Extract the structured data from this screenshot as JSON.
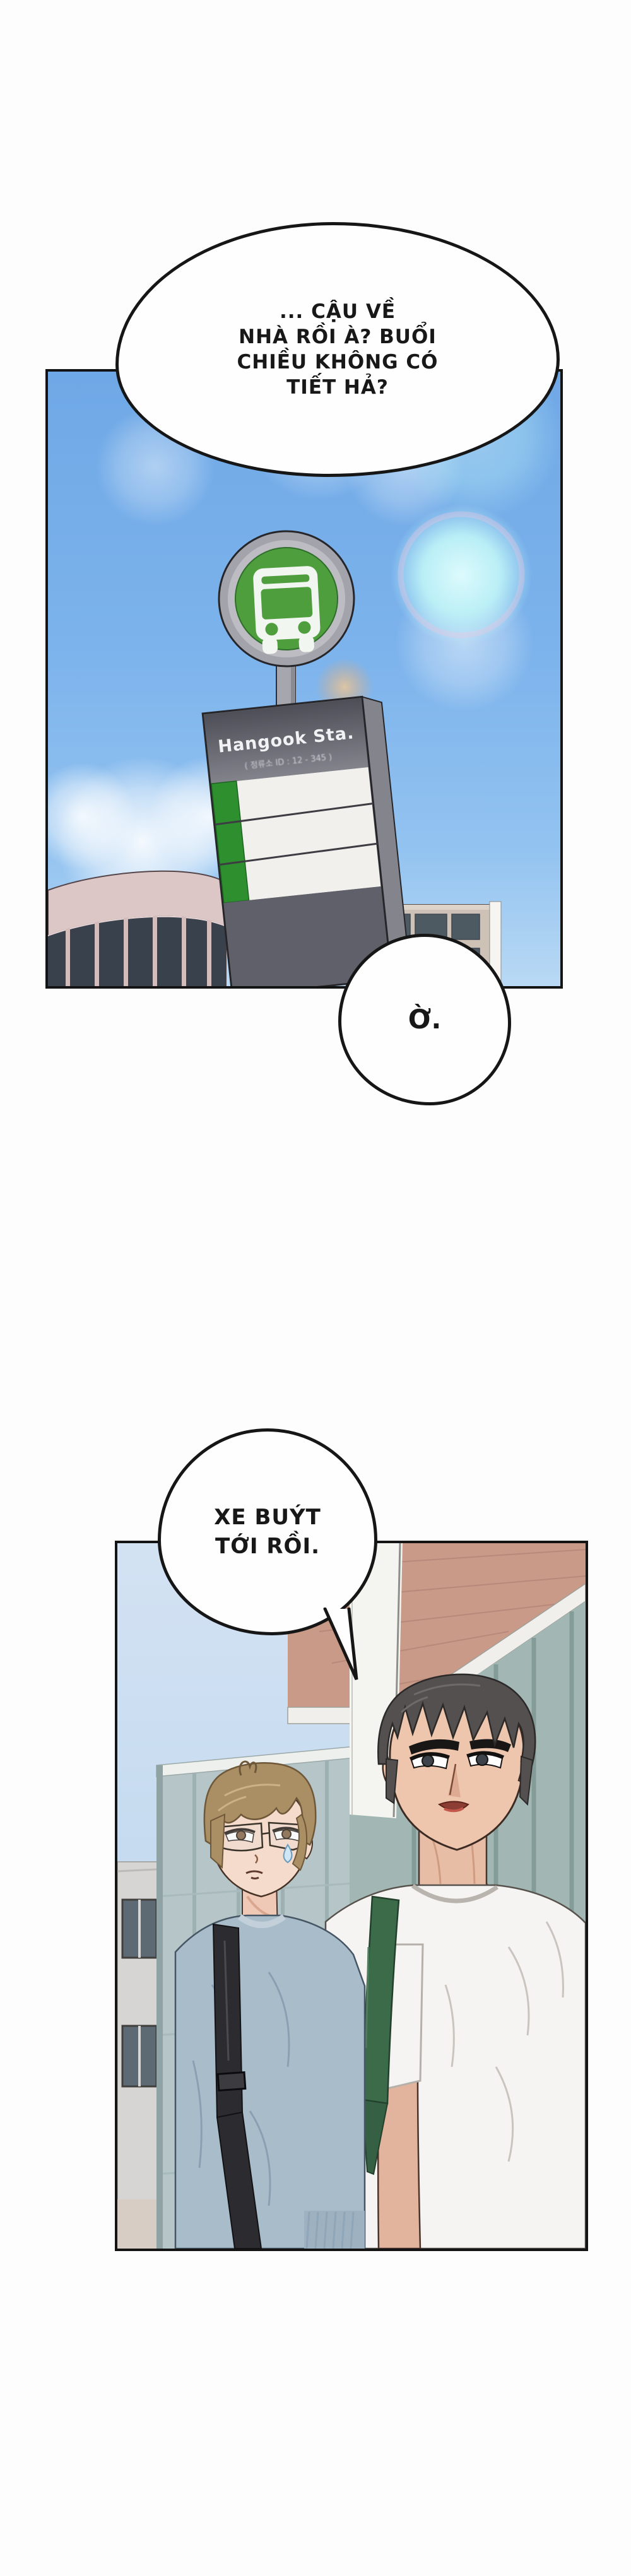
{
  "page": {
    "kind": "manhwa-page",
    "background": "#fdfdfd",
    "panel_border_color": "#141414"
  },
  "bubbles": {
    "b1": {
      "lines": [
        "... CẬU VỀ",
        "NHÀ RỒI À? BUỔI",
        "CHIỀU KHÔNG CÓ",
        "TIẾT HẢ?"
      ]
    },
    "b2": {
      "text": "Ờ."
    },
    "b3": {
      "lines": [
        "XE BUÝT",
        "TỚI RỒI."
      ]
    }
  },
  "bus_sign": {
    "station_name": "Hangook Sta.",
    "station_id_label": "( 정류소 ID : 12 - 345 )",
    "icon": "bus-icon"
  },
  "colors": {
    "sky_blue": "#74aee9",
    "flare_cyan": "#bef3f7",
    "flare_orange": "#f4a25c",
    "sign_green": "#4f9e3e",
    "sign_gray": "#a3a3ab",
    "sign_board_dark": "#65656d",
    "pink_building": "#dcc6c6",
    "beige_building": "#cec1b6",
    "brick_wall": "#c99a87",
    "teal_glass": "#a2b7b3",
    "sweater_blue": "#a9bcca",
    "tee_white": "#f5f4f2",
    "strap_green": "#3c6b4a",
    "strap_black": "#2c2c30",
    "hair_light_brown": "#ab8f64",
    "hair_dark_gray": "#53504f"
  }
}
